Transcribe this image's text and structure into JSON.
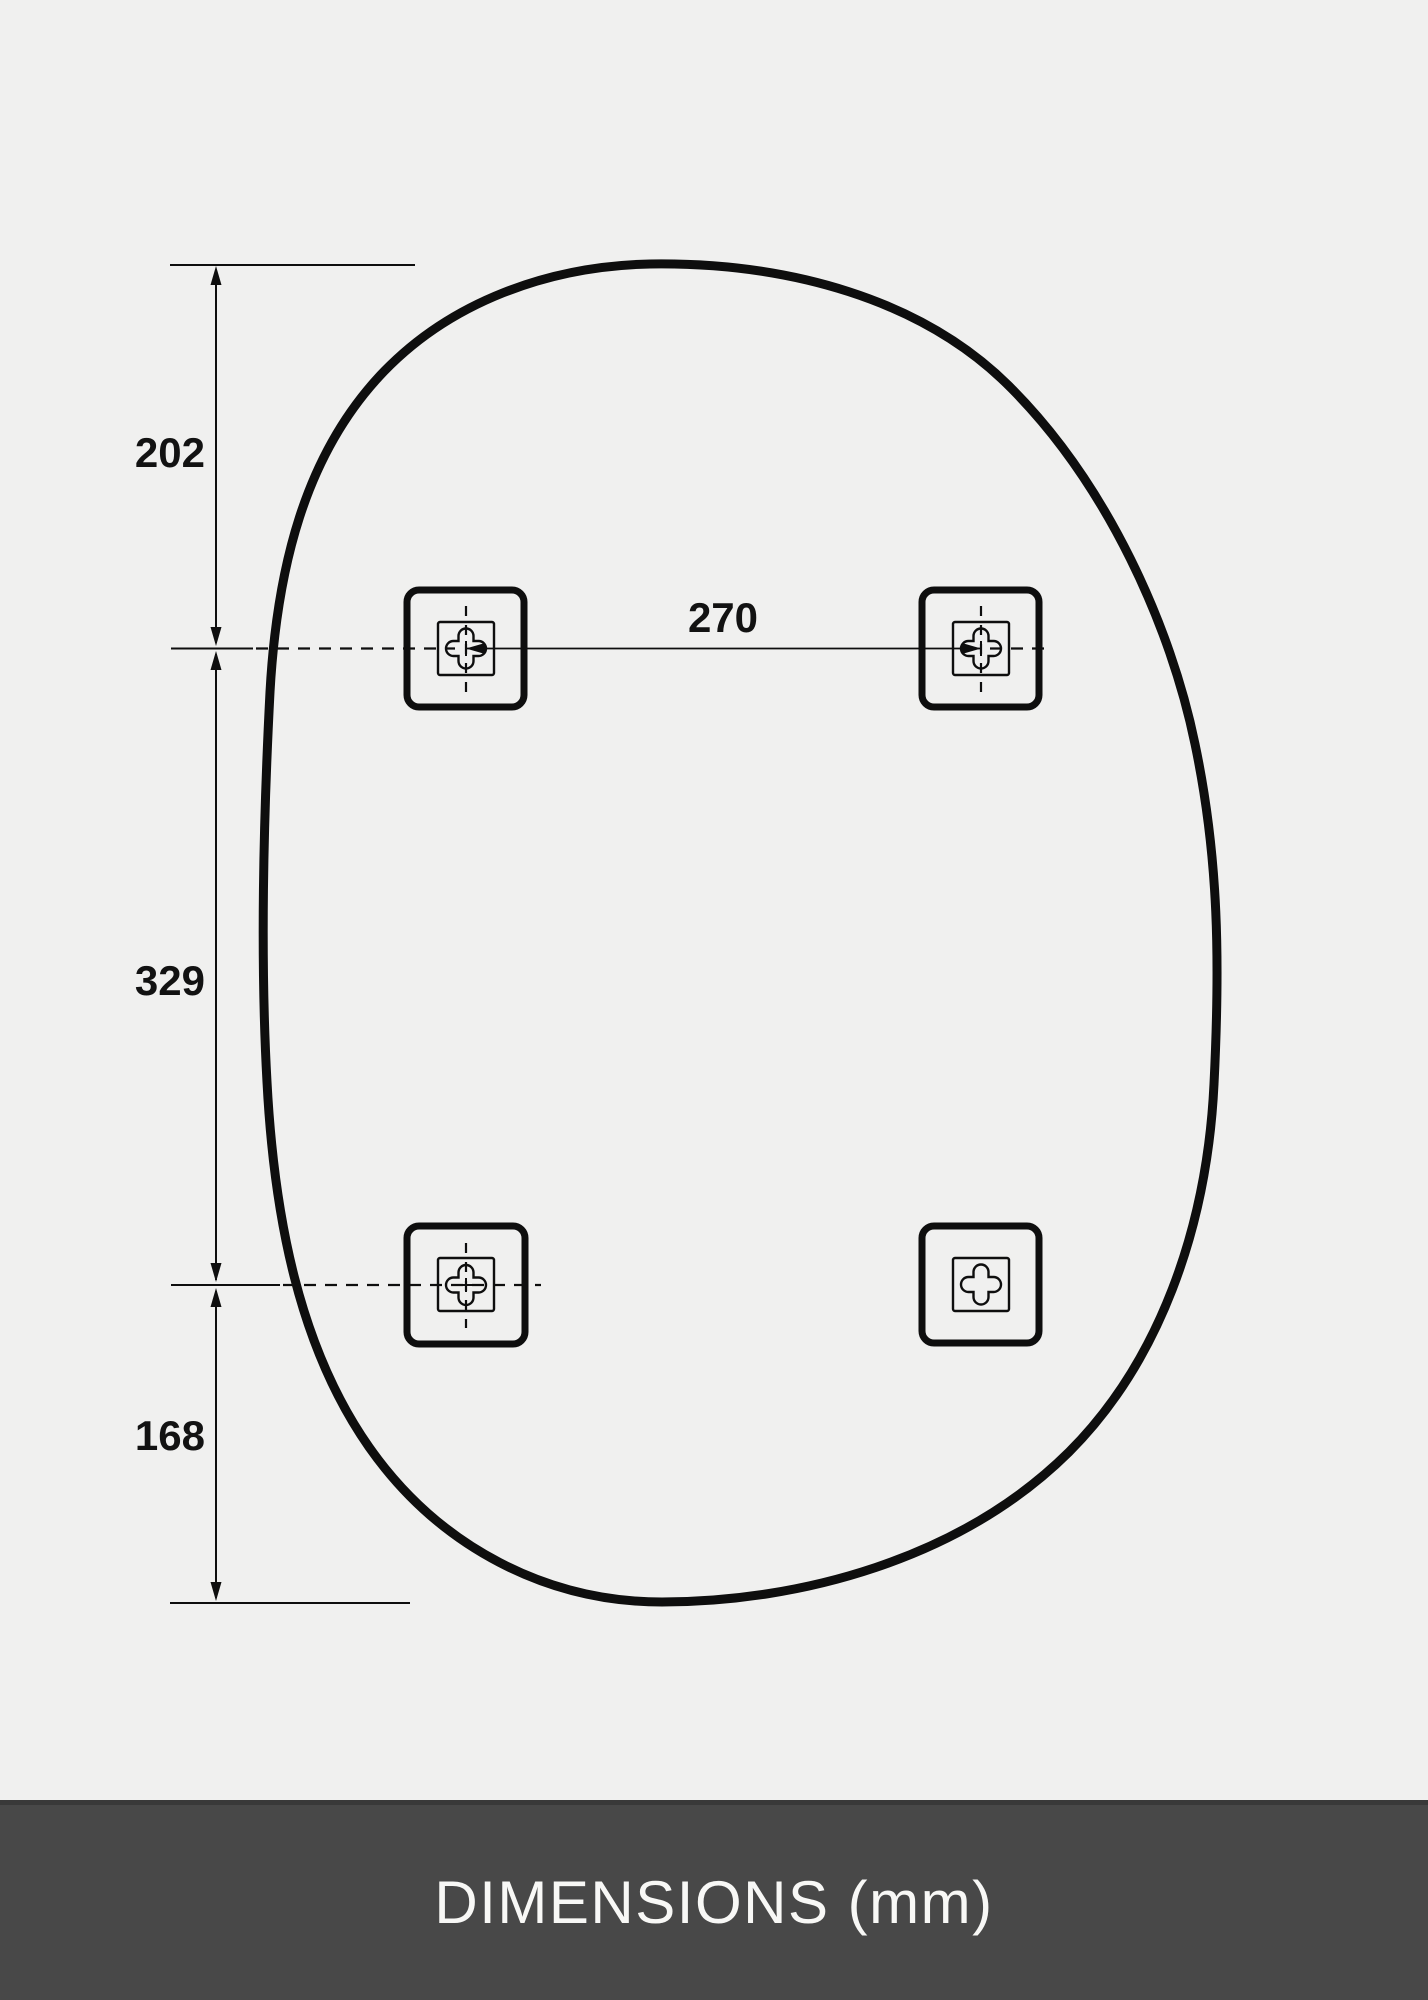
{
  "colors": {
    "background": "#f0f0ef",
    "line": "#0e0e0e",
    "footer_bg": "#484848",
    "footer_edge": "#393939",
    "footer_text": "#f8f8f6"
  },
  "dimensions": {
    "top_edge_to_holes": "202",
    "holes_horizontal_spacing": "270",
    "holes_vertical_spacing": "329",
    "holes_to_bottom_edge": "168"
  },
  "footer": {
    "label": "DIMENSIONS (mm)"
  }
}
